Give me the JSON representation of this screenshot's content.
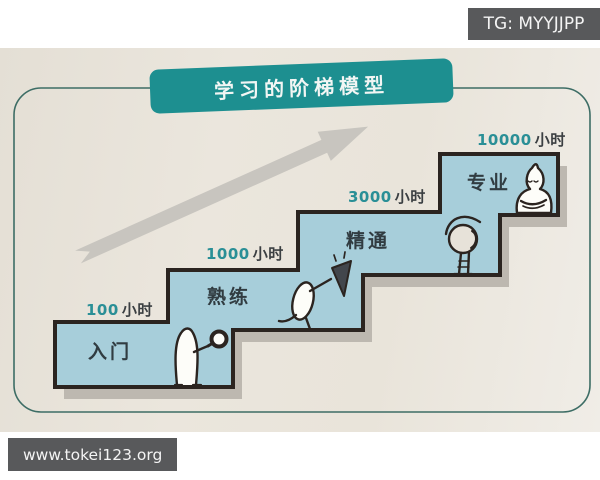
{
  "watermarks": {
    "telegram_badge": "TG: MYYJJPP",
    "website_badge": "www.tokei123.org"
  },
  "diagram": {
    "title": "学习的阶梯模型",
    "arrow": "upward-trend-arrow",
    "steps": [
      {
        "hours_number": "100",
        "hours_unit": "小时",
        "label": "入门",
        "character": "figure-holding-magnifier"
      },
      {
        "hours_number": "1000",
        "hours_unit": "小时",
        "label": "熟练",
        "character": "figure-holding-pennant"
      },
      {
        "hours_number": "3000",
        "hours_unit": "小时",
        "label": "精通",
        "character": "figure-bowing"
      },
      {
        "hours_number": "10000",
        "hours_unit": "小时",
        "label": "专业",
        "character": "figure-meditating"
      }
    ],
    "colors": {
      "badge_teal": "#1d8f90",
      "step_fill": "#a7ceda",
      "step_outline": "#2b2420",
      "shadow_gray": "#bdb8b0",
      "arrow_gray": "#c8c5bf",
      "border_green": "#3d6d65",
      "hours_number_teal": "#2a8f96",
      "paper_beige": "#eae5dc",
      "watermark_gray": "#58595b"
    }
  }
}
